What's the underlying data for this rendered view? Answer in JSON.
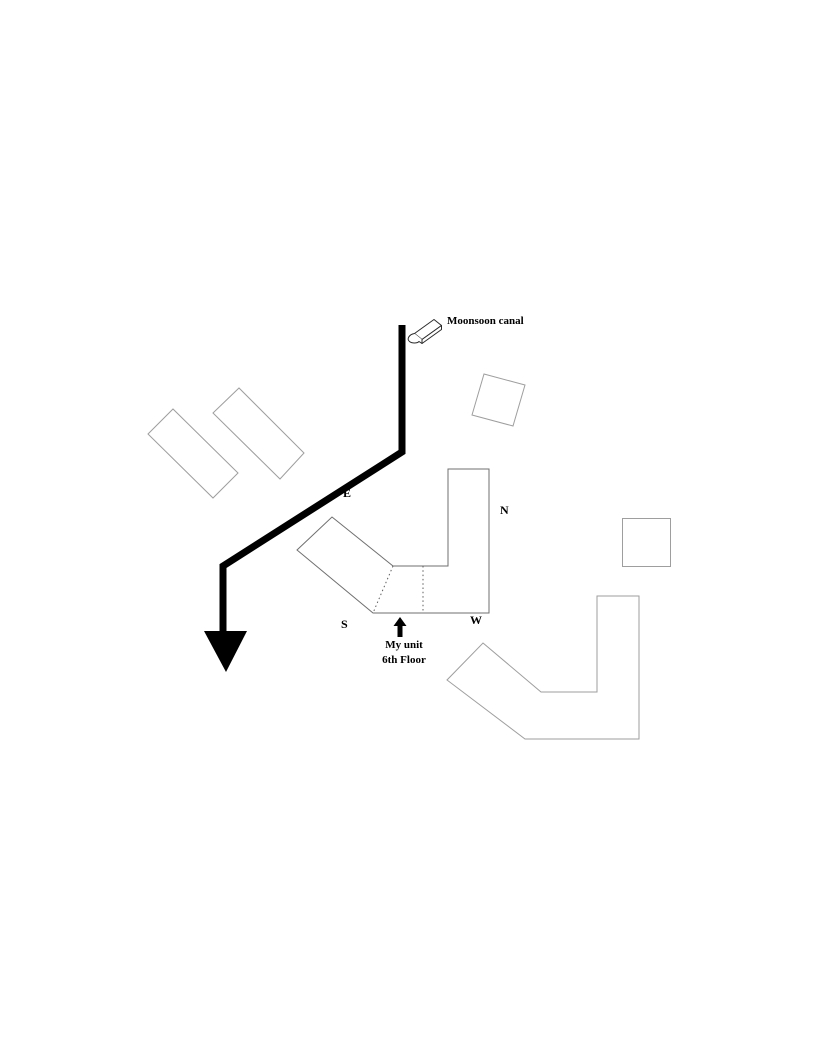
{
  "drawing": {
    "canal": {
      "label": "Moonsoon canal",
      "flow_icon": "3d-arrow-down-left-icon",
      "direction_icon": "large-down-arrowhead-icon"
    },
    "compass": {
      "north": "N",
      "east": "E",
      "south": "S",
      "west": "W"
    },
    "my_unit": {
      "pointer_icon": "small-up-arrow-icon",
      "label": "My unit",
      "floor": "6th Floor"
    }
  },
  "colors": {
    "background": "#ffffff",
    "canal": "#000000",
    "building_outline": "#9e9e9e",
    "unit_building_outline": "#6f6f6f",
    "divider": "#5e5e5e",
    "text": "#000000"
  }
}
